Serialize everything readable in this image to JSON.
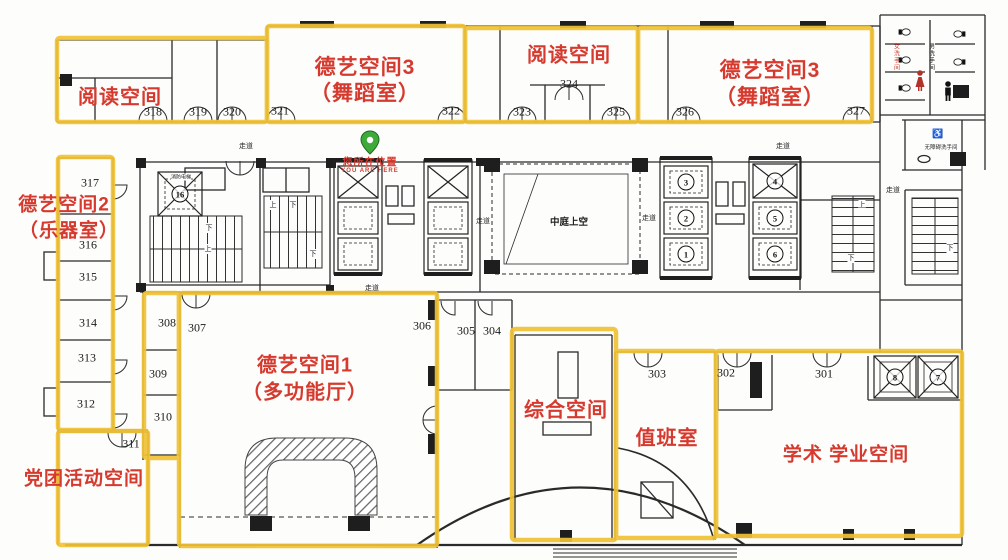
{
  "colors": {
    "region_highlight": "#F0C235",
    "label_red": "#D63A2E",
    "pin_green": "#3FA93C",
    "wall": "#2a2a2a"
  },
  "regions": {
    "reading_west": {
      "label": "阅读空间"
    },
    "dance_west": {
      "line1": "德艺空间3",
      "line2": "（舞蹈室）"
    },
    "reading_mid": {
      "label": "阅读空间"
    },
    "dance_east": {
      "line1": "德艺空间3",
      "line2": "（舞蹈室）"
    },
    "instrument": {
      "line1": "德艺空间2",
      "line2": "（乐器室）"
    },
    "party": {
      "label": "党团活动空间"
    },
    "multifunction": {
      "line1": "德艺空间1",
      "line2": "（多功能厅）"
    },
    "comprehensive": {
      "label": "综合空间"
    },
    "duty": {
      "label": "值班室"
    },
    "academic": {
      "label": "学术 学业空间"
    }
  },
  "rooms": {
    "r301": "301",
    "r302": "302",
    "r303": "303",
    "r304": "304",
    "r305": "305",
    "r306": "306",
    "r307": "307",
    "r308": "308",
    "r309": "309",
    "r310": "310",
    "r311": "311",
    "r312": "312",
    "r313": "313",
    "r314": "314",
    "r315": "315",
    "r316": "316",
    "r317": "317",
    "r318": "318",
    "r319": "319",
    "r320": "320",
    "r321": "321",
    "r322": "322",
    "r323": "323",
    "r324": "324",
    "r325": "325",
    "r326": "326",
    "r327": "327"
  },
  "you_are_here": {
    "zh": "您所在位置",
    "en": "YOU ARE HERE"
  },
  "plan_labels": {
    "atrium": "中庭上空",
    "corridor": "走道",
    "mens_restroom": "男洗手间",
    "womens_restroom": "女洗手间",
    "accessible_restroom": "无障碍洗手间",
    "fire_elevator": "消防电梯",
    "up": "上",
    "down": "下"
  },
  "elevators": {
    "e1": "1",
    "e2": "2",
    "e3": "3",
    "e4": "4",
    "e5": "5",
    "e6": "6",
    "e7": "7",
    "e8": "8",
    "e16": "16"
  },
  "icons": {
    "wheelchair": "♿"
  }
}
